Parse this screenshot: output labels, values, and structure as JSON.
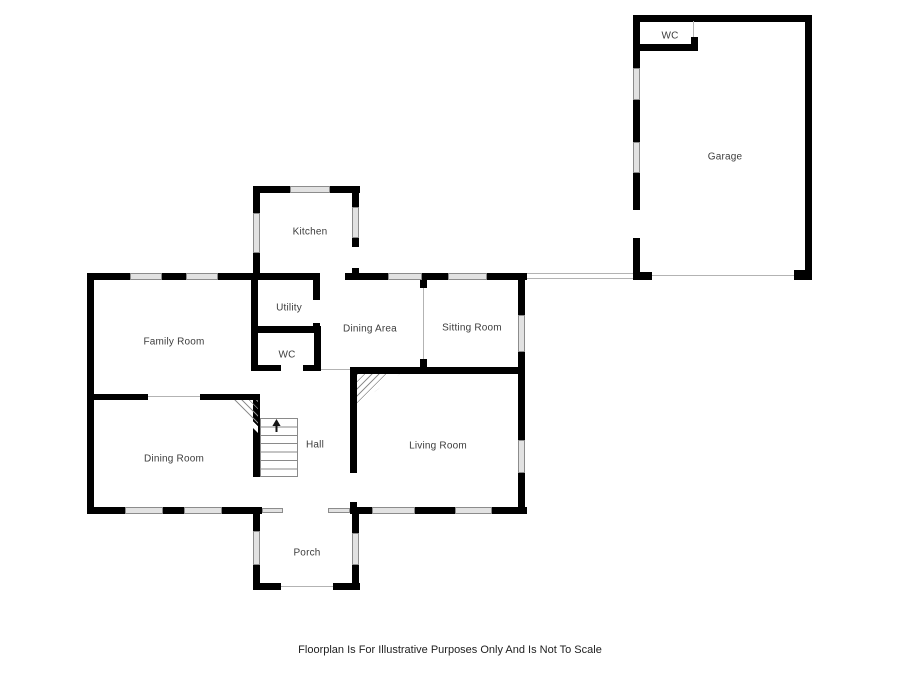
{
  "title": "Floorplan",
  "colors": {
    "background": "#ffffff",
    "wall": "#000000",
    "window_fill": "#e2e2e2",
    "window_edge": "#8c8c8c",
    "opening_line": "#b3b3b3",
    "label_color": "#3c3c3c",
    "caption_color": "#1e1e1e"
  },
  "rooms": {
    "garage_wc": {
      "label": "WC"
    },
    "garage": {
      "label": "Garage"
    },
    "kitchen": {
      "label": "Kitchen"
    },
    "utility": {
      "label": "Utility"
    },
    "dining_area": {
      "label": "Dining Area"
    },
    "sitting_room": {
      "label": "Sitting Room"
    },
    "family_room": {
      "label": "Family Room"
    },
    "wc": {
      "label": "WC"
    },
    "hall": {
      "label": "Hall"
    },
    "living_room": {
      "label": "Living Room"
    },
    "dining_room": {
      "label": "Dining Room"
    },
    "porch": {
      "label": "Porch"
    }
  },
  "stairs": {
    "direction": "up"
  },
  "footer": {
    "caption": "Floorplan Is For Illustrative Purposes Only And Is Not To Scale"
  }
}
